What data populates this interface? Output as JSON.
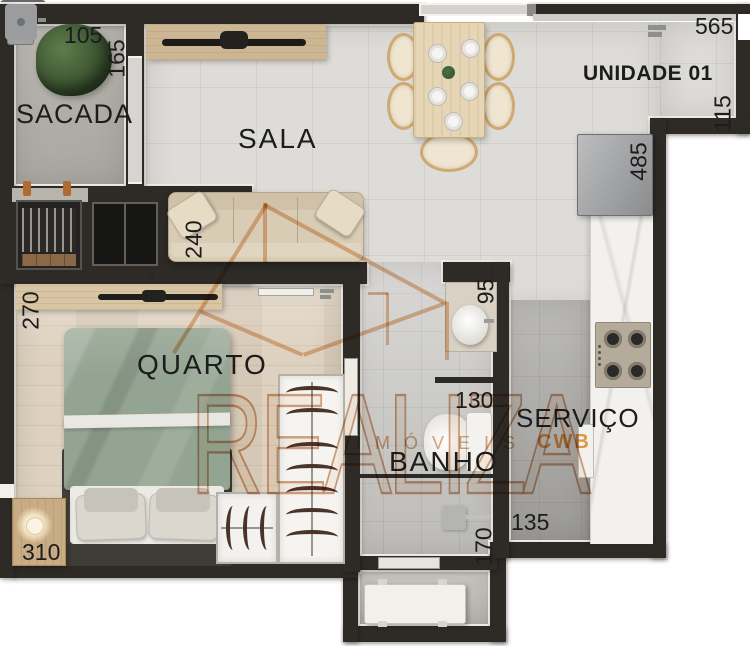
{
  "unit": {
    "label": "UNIDADE 01"
  },
  "rooms": {
    "sacada": "SACADA",
    "sala": "SALA",
    "quarto": "QUARTO",
    "banho": "BANHO",
    "servico": "SERVIÇO"
  },
  "dims": {
    "sacada_width": "105",
    "sacada_depth": "165",
    "top_wall": "565",
    "right_wall_segment": "115",
    "kitchen_run": "485",
    "sofa_length": "240",
    "quarto_depth": "270",
    "banho_counter": "95",
    "banho_width": "130",
    "quarto_width": "310",
    "servico_width": "135",
    "banho_depth": "170"
  },
  "watermark": {
    "brand": "REALIZA",
    "line2": "IMÓVEIS",
    "line3": "CWB"
  },
  "colors": {
    "wall": "#2e2b27",
    "wall_outline": "#f3f0e9",
    "label": "#1c1c1c",
    "watermark_tan": "#d8a87e",
    "watermark_orange": "#e8953d",
    "bed_duvet": "#94a492",
    "wood_furniture": "#d8c5a3"
  },
  "furniture": [
    "tree-plant",
    "barbecue-grill",
    "balcony-window",
    "tv-panel",
    "dining-table",
    "dining-chair",
    "plate",
    "sofa",
    "fridge",
    "kitchen-sink",
    "cooktop",
    "laundry-sink",
    "cabinet-door",
    "bathroom-counter",
    "bathroom-sink",
    "toilet",
    "shower-head",
    "shower-partition",
    "double-bed",
    "pillow",
    "nightstand",
    "table-lamp",
    "wardrobe-hangers",
    "closet-rack",
    "bedroom-tv-console",
    "entry-door-handle",
    "sliding-door",
    "utility-bench"
  ]
}
